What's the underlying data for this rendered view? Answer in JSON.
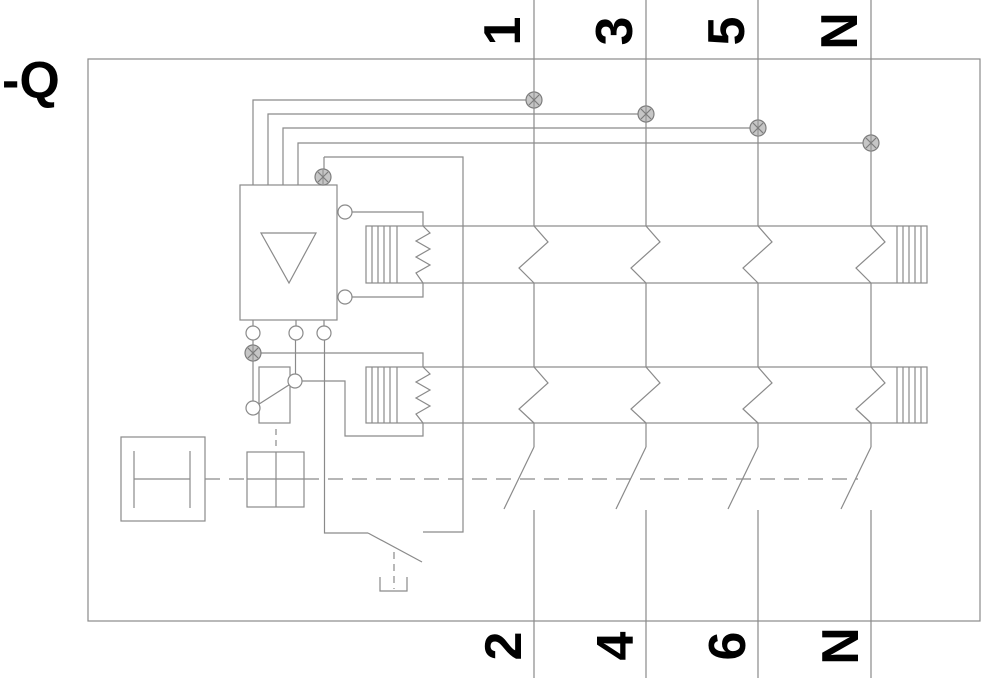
{
  "ref_label": "-Q",
  "colors": {
    "line": "#8a8a8a",
    "text": "#000000",
    "clamp_fill": "#c6c6c6",
    "clamp_stroke": "#7d7d7d",
    "background": "#ffffff"
  },
  "poles": [
    {
      "top_label": "1",
      "bottom_label": "2",
      "x": 534,
      "tap_y": 100
    },
    {
      "top_label": "3",
      "bottom_label": "4",
      "x": 646,
      "tap_y": 114
    },
    {
      "top_label": "5",
      "bottom_label": "6",
      "x": 758,
      "tap_y": 128
    },
    {
      "top_label": "N",
      "bottom_label": "N",
      "x": 871,
      "tap_y": 143
    }
  ]
}
